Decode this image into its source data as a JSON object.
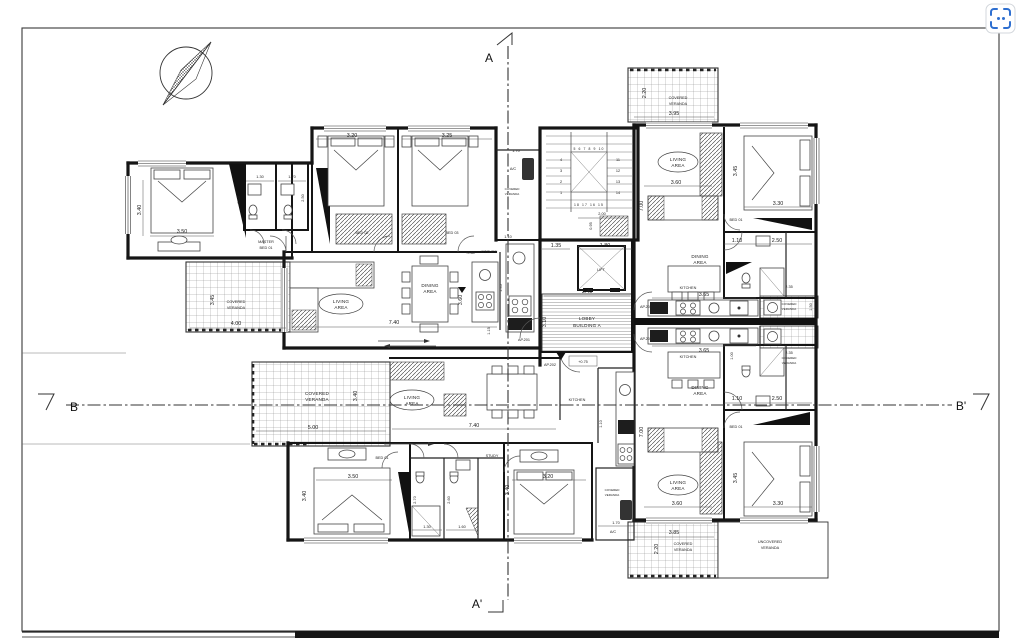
{
  "ui": {
    "accent": "#2e6fd0"
  },
  "sections": {
    "a_top": "A",
    "a_bottom": "A'",
    "b_left": "B",
    "b_right": "B'"
  },
  "core": {
    "stair": {
      "row_top": "5 6 7 8 9 10",
      "row_bottom": "18 17 16 15",
      "left": [
        "4",
        "3",
        "2",
        "1"
      ],
      "right": [
        "11",
        "12",
        "13",
        "14"
      ],
      "width_left": "1.35",
      "width_right": "1.80",
      "landing_w": "2.00",
      "landing_h": "0.95"
    },
    "lift_label": "LIFT",
    "lobby": {
      "line1": "LOBBY",
      "line2": "BUILDING A",
      "width": "3.40",
      "depth": "3.10",
      "level": "+0.75"
    },
    "doors": {
      "ap201": "AP.201",
      "ap202": "AP.202",
      "ap203": "AP.203",
      "ap204": "AP.204"
    }
  },
  "ap201": {
    "master": {
      "line1": "MASTER",
      "line2": "BED 01",
      "w": "3.50",
      "h": "3.40"
    },
    "bath1": {
      "w": "1.30",
      "h": "2.60"
    },
    "bath2": {
      "w": "1.70",
      "h": "2.50"
    },
    "bed2": {
      "label": "BED 02",
      "w": "3.20"
    },
    "bed3": {
      "label": "BED 03",
      "w": "3.25"
    },
    "living": {
      "line1": "LIVING",
      "line2": "AREA",
      "w": "7.40",
      "level": "+0.80"
    },
    "dining": {
      "line1": "DINING",
      "line2": "AREA",
      "h": "3.60",
      "d1": "1.45",
      "d2": "1.15"
    },
    "kitchen": {
      "label": "KITCHEN",
      "d": "1.10"
    },
    "veranda": {
      "line1": "COVERED",
      "line2": "VERANDA",
      "w": "4.00",
      "h": "3.45"
    },
    "service": {
      "ac": "A/C",
      "w": "1.70",
      "line1": "COVERED",
      "line2": "VERANDA"
    }
  },
  "ap202": {
    "veranda": {
      "line1": "COVERED",
      "line2": "VERANDA",
      "w": "5.00",
      "h": "3.40"
    },
    "living": {
      "line1": "LIVING",
      "line2": "AREA",
      "w": "7.40"
    },
    "kitchen": {
      "label": "KITCHEN",
      "d": "1.10"
    },
    "bed1": {
      "label": "BED 01",
      "w": "3.50",
      "h": "3.40"
    },
    "bath1": {
      "h": "2.70",
      "w": "1.30"
    },
    "bath2": {
      "h": "2.60",
      "w": "1.60"
    },
    "study": {
      "label": "STUDY",
      "w": "3.20",
      "h": "3.40"
    },
    "veranda2": {
      "line1": "COVERED",
      "line2": "VERANDA",
      "w": "1.70",
      "ac": "A/C"
    }
  },
  "ap203": {
    "dining": {
      "line1": "DINING",
      "line2": "AREA"
    },
    "bath": {
      "w1": "1.10",
      "w2": "2.50"
    },
    "depth": "7.00",
    "bed": {
      "label": "BED 01",
      "w": "3.30",
      "h": "3.45"
    },
    "living": {
      "line1": "LIVING",
      "line2": "AREA",
      "w": "3.60"
    },
    "kitchen": {
      "label": "KITCHEN",
      "w": "3.65",
      "d": "1.00"
    },
    "side_veranda": {
      "w": "2.35",
      "line1": "COVERED",
      "line2": "VERANDA"
    },
    "veranda": {
      "w": "3.85",
      "h": "2.20",
      "line1": "COVERED",
      "line2": "VERANDA"
    },
    "uncovered": {
      "line1": "UNCOVERED",
      "line2": "VERANDA"
    }
  },
  "ap204": {
    "living": {
      "line1": "LIVING",
      "line2": "AREA",
      "w": "3.60"
    },
    "depth": "7.00",
    "bed": {
      "label": "BED 01",
      "w": "3.30",
      "h": "3.45"
    },
    "bath": {
      "w1": "1.10",
      "w2": "2.50"
    },
    "dining": {
      "line1": "DINING",
      "line2": "AREA"
    },
    "kitchen": {
      "label": "KITCHEN",
      "w": "3.65"
    },
    "side_veranda": {
      "w": "2.35",
      "h": "1.50",
      "line1": "COVERED",
      "line2": "VERANDA"
    },
    "veranda": {
      "w": "3.95",
      "h": "2.20",
      "line1": "COVERED",
      "line2": "VERANDA"
    }
  }
}
